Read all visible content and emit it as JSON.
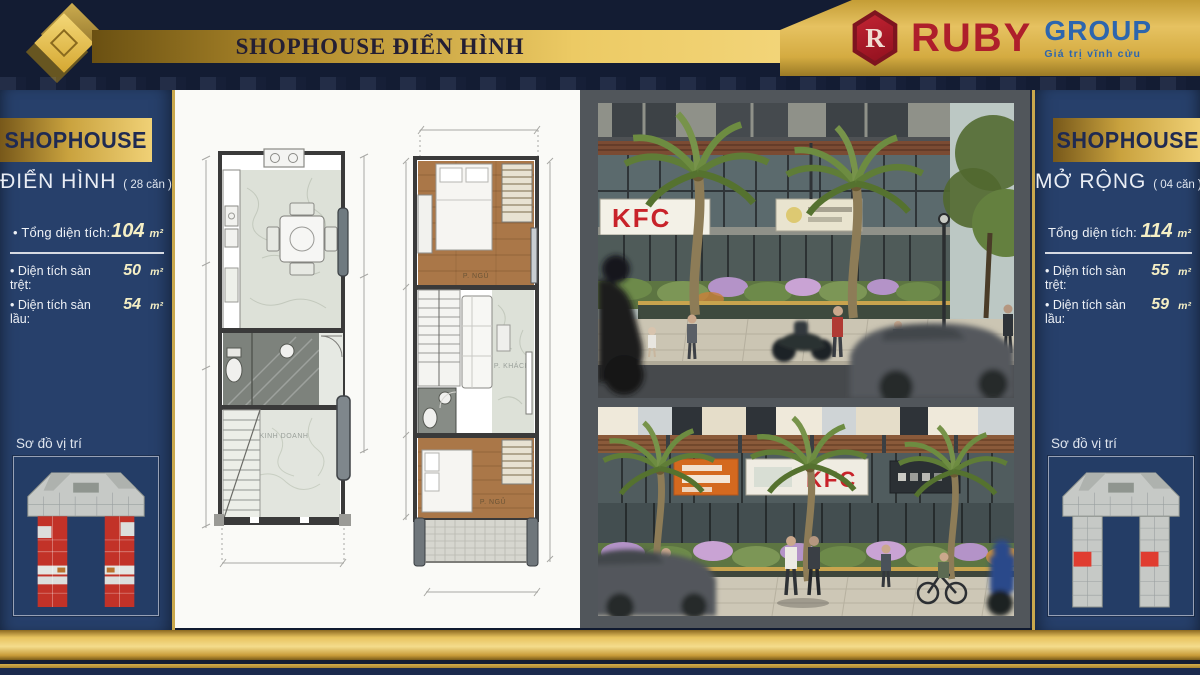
{
  "colors": {
    "header_navy": "#131c33",
    "panel_navy": "#27406b",
    "gold": "#e6c261",
    "ruby_red": "#ae1f2b",
    "group_blue": "#2d66ae",
    "siteplan_red": "#c23228",
    "kfc_red": "#c8232a"
  },
  "header": {
    "title": "SHOPHOUSE ĐIỂN HÌNH",
    "brand": {
      "monogram": "R",
      "name": "RUBY",
      "suffix": "GROUP",
      "tagline": "Giá trị vĩnh cửu"
    }
  },
  "left_panel": {
    "banner": "SHOPHOUSE",
    "subtitle": "ĐIỂN HÌNH",
    "subtitle_note": "( 28 căn )",
    "total": {
      "label": "Tổng diện tích:",
      "value": "104",
      "unit": "m²"
    },
    "rows": [
      {
        "label": "Diện tích sàn trệt:",
        "value": "50",
        "unit": "m²"
      },
      {
        "label": "Diện tích sàn lầu:",
        "value": "54",
        "unit": "m²"
      }
    ],
    "map_label": "Sơ đồ vị trí"
  },
  "right_panel": {
    "banner": "SHOPHOUSE",
    "subtitle": "MỞ RỘNG",
    "subtitle_note": "( 04 căn )",
    "total": {
      "label": "Tổng diện tích:",
      "value": "114",
      "unit": "m²"
    },
    "rows": [
      {
        "label": "Diện tích sàn trệt:",
        "value": "55",
        "unit": "m²"
      },
      {
        "label": "Diện tích sàn lầu:",
        "value": "59",
        "unit": "m²"
      }
    ],
    "map_label": "Sơ đồ vị trí"
  },
  "plans": {
    "plan1": {
      "room_label": "KINH DOANH"
    },
    "plan2": {
      "bedroom_label": "P. NGỦ",
      "living_label": "P. KHÁCH",
      "bedroom2_label": "P. NGỦ"
    }
  },
  "renders": {
    "top_sign": "KFC",
    "bottom_sign": "KFC"
  }
}
